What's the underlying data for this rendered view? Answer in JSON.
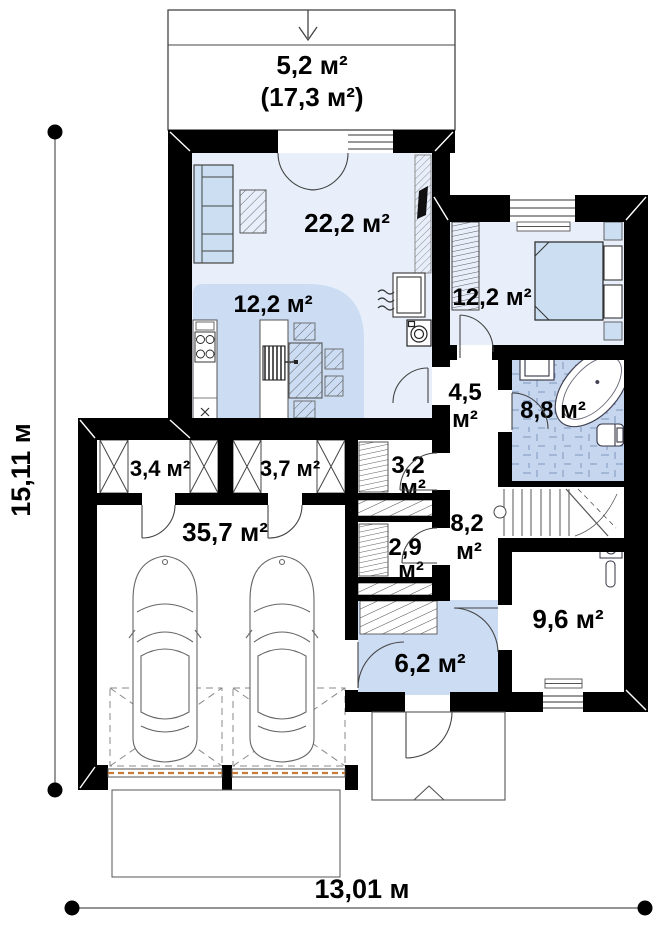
{
  "plan_title": "floor-plan",
  "rooms": {
    "terrace": {
      "area": "5,2 м²",
      "total": "(17,3 м²)"
    },
    "living": {
      "area": "22,2 м²"
    },
    "kitchen": {
      "area": "12,2 м²"
    },
    "bedroom": {
      "area": "12,2 м²"
    },
    "hall": {
      "area": "4,5",
      "unit": "м²"
    },
    "bathroom": {
      "area": "8,8 м²"
    },
    "closet_1": {
      "area": "3,2",
      "unit": "м²"
    },
    "closet_2": {
      "area": "2,9",
      "unit": "м²"
    },
    "hall_2": {
      "area": "8,2",
      "unit": "м²"
    },
    "storage_1": {
      "area": "3,4 м²"
    },
    "storage_2": {
      "area": "3,7 м²"
    },
    "garage": {
      "area": "35,7 м²"
    },
    "cabinet": {
      "area": "9,6 м²"
    },
    "entry": {
      "area": "6,2 м²"
    }
  },
  "dimensions": {
    "height_label": "15,11 м",
    "width_label": "13,01 м"
  },
  "colors": {
    "wall": "#000000",
    "room_light": "#e9effa",
    "zone_medium": "#ccdcf3",
    "bath_floor": "#c6d6ef",
    "furniture": "#ccdff2",
    "garage_door_accent": "#c87c3a",
    "line": "#444444"
  }
}
